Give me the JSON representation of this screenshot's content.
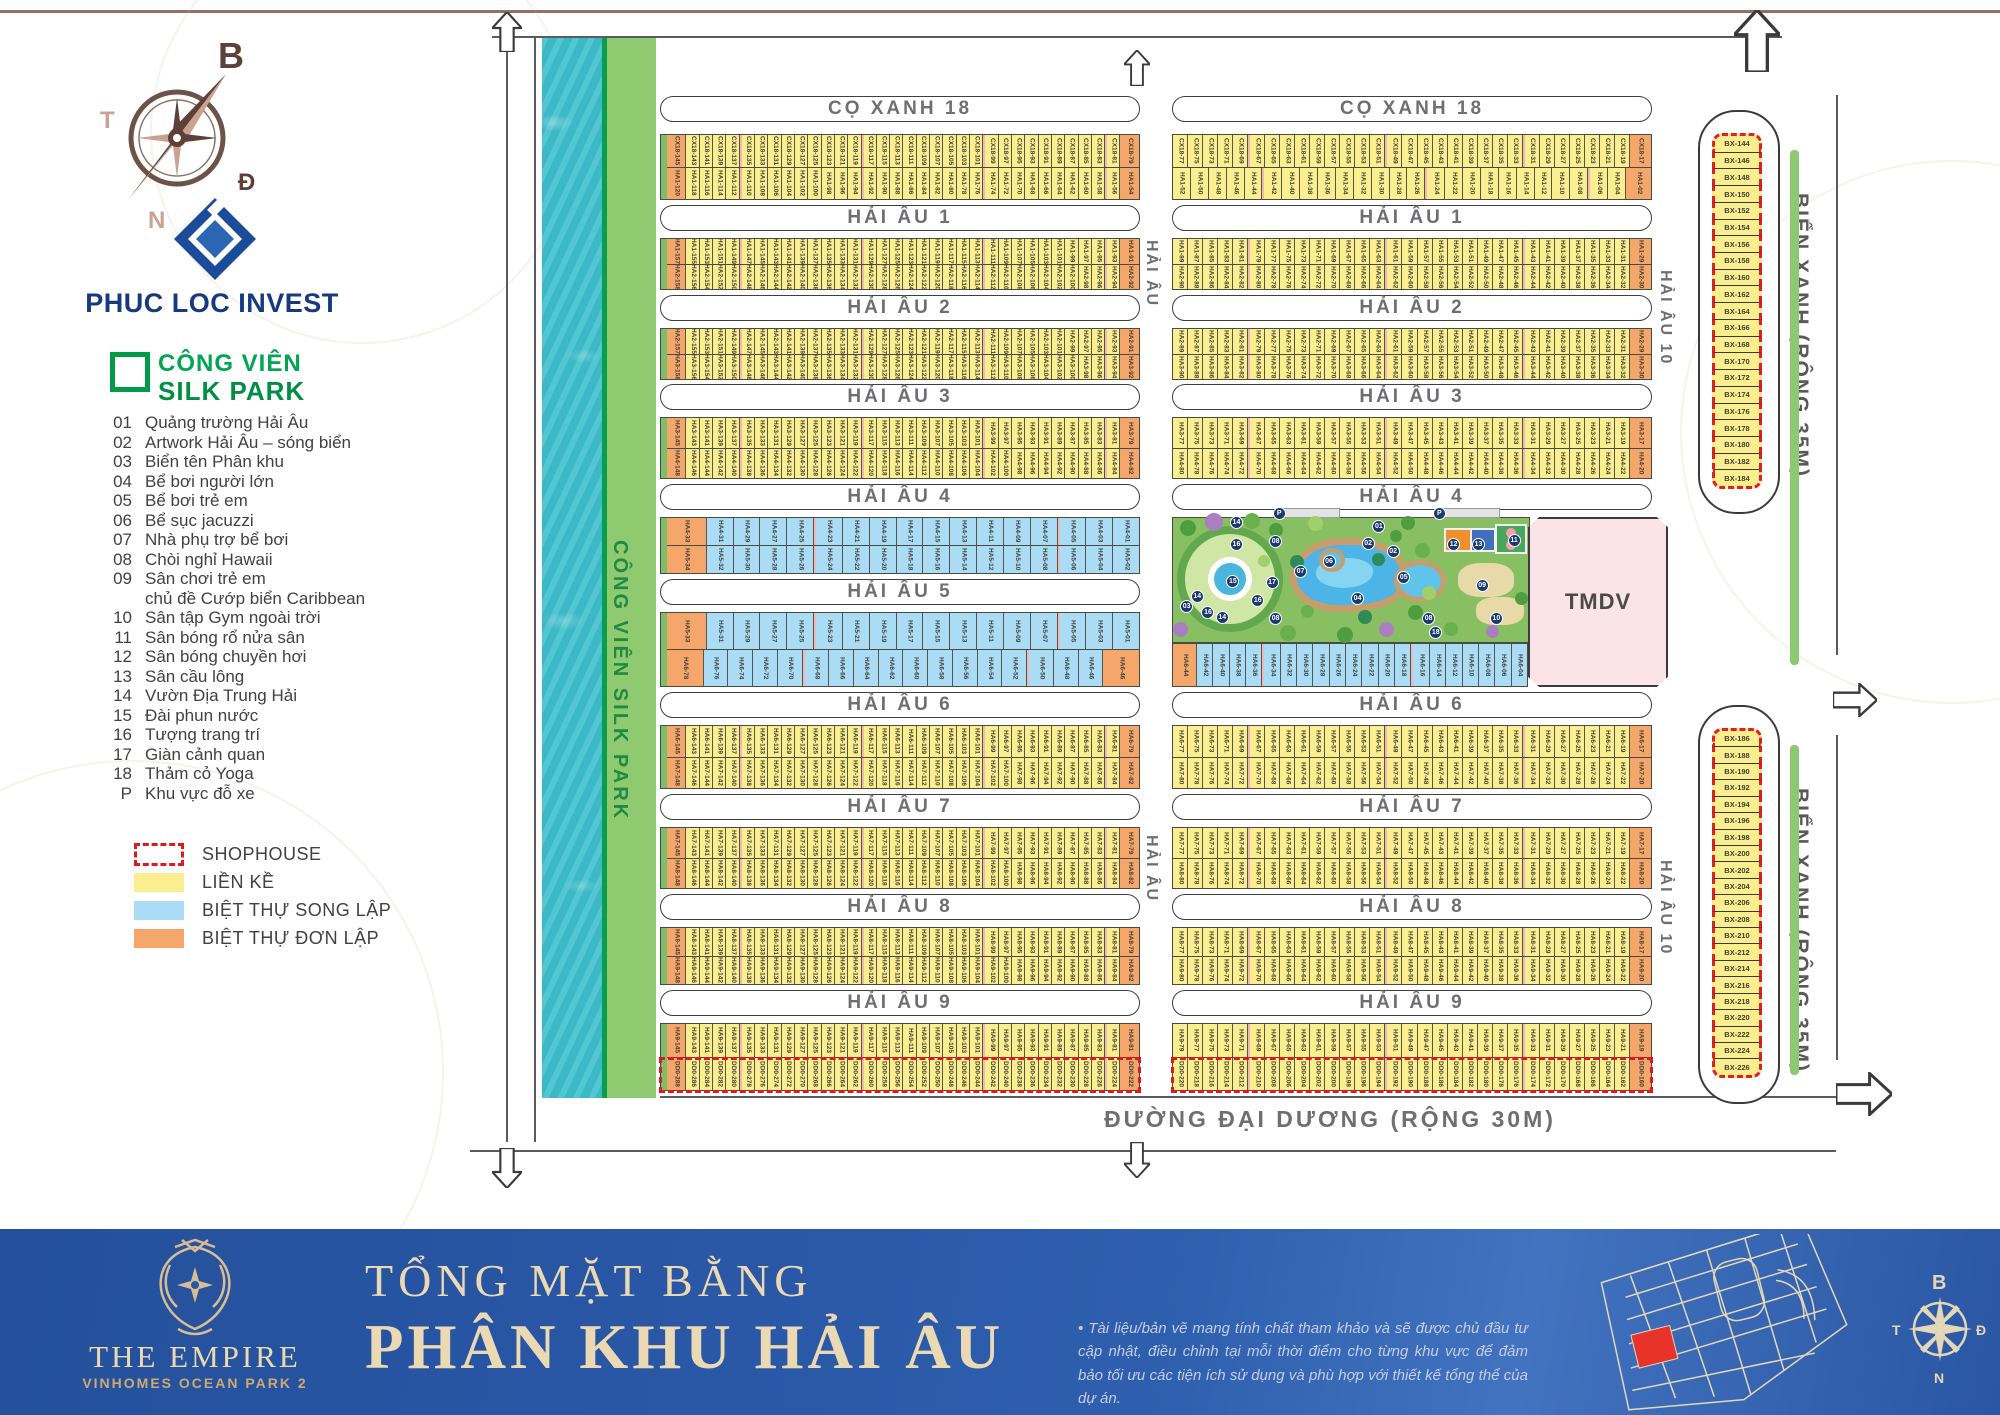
{
  "page_title": "Tổng mặt bằng Phân khu Hải Âu",
  "sidebar": {
    "compass": {
      "north": "B",
      "east": "Đ",
      "south": "N",
      "west": "T"
    },
    "brand": "PHUC LOC INVEST",
    "park_legend": {
      "line1": "CÔNG VIÊN",
      "line2": "SILK PARK"
    },
    "amenities": [
      {
        "no": "01",
        "label": "Quảng trường Hải Âu"
      },
      {
        "no": "02",
        "label": "Artwork Hải Âu – sóng biển"
      },
      {
        "no": "03",
        "label": "Biển tên Phân khu"
      },
      {
        "no": "04",
        "label": "Bể bơi người lớn"
      },
      {
        "no": "05",
        "label": "Bể bơi trẻ em"
      },
      {
        "no": "06",
        "label": "Bể sục jacuzzi"
      },
      {
        "no": "07",
        "label": "Nhà phụ trợ bể bơi"
      },
      {
        "no": "08",
        "label": "Chòi nghỉ Hawaii"
      },
      {
        "no": "09",
        "label": "Sân chơi trẻ em",
        "label2": "chủ đề Cướp biển Caribbean"
      },
      {
        "no": "10",
        "label": "Sân tập Gym ngoài trời"
      },
      {
        "no": "11",
        "label": "Sân bóng rổ nửa sân"
      },
      {
        "no": "12",
        "label": "Sân bóng chuyền hơi"
      },
      {
        "no": "13",
        "label": "Sân cầu lông"
      },
      {
        "no": "14",
        "label": "Vườn Địa Trung Hải"
      },
      {
        "no": "15",
        "label": "Đài phun nước"
      },
      {
        "no": "16",
        "label": "Tượng trang trí"
      },
      {
        "no": "17",
        "label": "Giàn cảnh quan"
      },
      {
        "no": "18",
        "label": "Thảm cỏ Yoga"
      },
      {
        "no": "P",
        "label": "Khu vực đỗ xe"
      }
    ],
    "type_legend": [
      {
        "key": "shophouse",
        "label": "SHOPHOUSE"
      },
      {
        "key": "lienke",
        "label": "LIỀN KỀ"
      },
      {
        "key": "songlap",
        "label": "BIỆT THỰ SONG LẬP"
      },
      {
        "key": "donlap",
        "label": "BIỆT THỰ ĐƠN LẬP"
      }
    ]
  },
  "colors": {
    "lienke": "#fbee8f",
    "songlap": "#abdcf5",
    "donlap": "#f4a66b",
    "shophouse_dash": "#e0191f",
    "park_green": "#8fca70",
    "water": "#3fbfcc",
    "tmdv_pink": "#fbe4e7",
    "footer_blue": "#2a58a7",
    "footer_cream": "#ead9b3"
  },
  "map": {
    "silk_park_vertical_label": "CÔNG VIÊN SILK PARK",
    "bien_xanh_label": "BIỂN XANH (RỘNG 35M)",
    "dai_duong_label": "ĐƯỜNG ĐẠI DƯƠNG (RỘNG 30M)",
    "hai_au_road_label": "HẢI ÂU",
    "hai_au_10_label": "HẢI ÂU 10",
    "tmdv_label": "TMDV",
    "streets": [
      {
        "label": "CỌ XANH 18",
        "y": 96,
        "groups": [
          "L",
          "R"
        ]
      },
      {
        "label": "HẢI ÂU 1",
        "y": 205,
        "groups": [
          "L",
          "R"
        ]
      },
      {
        "label": "HẢI ÂU 2",
        "y": 295,
        "groups": [
          "L",
          "R"
        ]
      },
      {
        "label": "HẢI ÂU 3",
        "y": 384,
        "groups": [
          "L",
          "R"
        ]
      },
      {
        "label": "HẢI ÂU 4",
        "y": 484,
        "groups": [
          "L",
          "R"
        ]
      },
      {
        "label": "HẢI ÂU 5",
        "y": 579,
        "groups": [
          "L"
        ]
      },
      {
        "label": "HẢI ÂU 6",
        "y": 692,
        "groups": [
          "L",
          "R"
        ]
      },
      {
        "label": "HẢI ÂU 7",
        "y": 794,
        "groups": [
          "L",
          "R"
        ]
      },
      {
        "label": "HẢI ÂU 8",
        "y": 894,
        "groups": [
          "L",
          "R"
        ]
      },
      {
        "label": "HẢI ÂU 9",
        "y": 990,
        "groups": [
          "L",
          "R"
        ]
      }
    ],
    "blocks": [
      {
        "g": "L",
        "y": 134,
        "h": 66,
        "t": "y",
        "rows": [
          {
            "p": "CX18",
            "o1": 145,
            "s": 143,
            "n": 32,
            "o2": 79
          },
          {
            "p": "HA1",
            "o1": 120,
            "s": 118,
            "n": 32,
            "o2": 54
          }
        ]
      },
      {
        "g": "R",
        "y": 134,
        "h": 66,
        "t": "y",
        "rows": [
          {
            "p": "CX18",
            "s": 77,
            "n": 30,
            "o2": 17
          },
          {
            "p": "HA1",
            "s": 52,
            "n": 25,
            "o2": 2
          }
        ]
      },
      {
        "g": "L",
        "y": 238,
        "h": 52,
        "t": "y",
        "rows": [
          {
            "p": "HA1",
            "o1": 157,
            "s": 155,
            "n": 32,
            "o2": 91
          },
          {
            "p": "HA2",
            "o1": 158,
            "s": 156,
            "n": 32,
            "o2": 92
          }
        ]
      },
      {
        "g": "R",
        "y": 238,
        "h": 52,
        "t": "y",
        "rows": [
          {
            "p": "HA1",
            "s": 89,
            "n": 30,
            "o2": 29
          },
          {
            "p": "HA2",
            "s": 90,
            "n": 30,
            "o2": 30
          }
        ]
      },
      {
        "g": "L",
        "y": 328,
        "h": 52,
        "t": "y",
        "rows": [
          {
            "p": "HA2",
            "o1": 157,
            "s": 155,
            "n": 32,
            "o2": 91
          },
          {
            "p": "HA3",
            "o1": 158,
            "s": 156,
            "n": 32,
            "o2": 92
          }
        ]
      },
      {
        "g": "R",
        "y": 328,
        "h": 52,
        "t": "y",
        "rows": [
          {
            "p": "HA2",
            "s": 89,
            "n": 30,
            "o2": 29
          },
          {
            "p": "HA3",
            "s": 90,
            "n": 30,
            "o2": 30
          }
        ]
      },
      {
        "g": "L",
        "y": 417,
        "h": 62,
        "t": "y",
        "rows": [
          {
            "p": "HA3",
            "o1": 145,
            "s": 143,
            "n": 32,
            "o2": 79
          },
          {
            "p": "HA4",
            "o1": 148,
            "s": 146,
            "n": 32,
            "o2": 82
          }
        ]
      },
      {
        "g": "R",
        "y": 417,
        "h": 62,
        "t": "y",
        "rows": [
          {
            "p": "HA3",
            "s": 77,
            "n": 30,
            "o2": 17
          },
          {
            "p": "HA4",
            "s": 80,
            "n": 30,
            "o2": 20
          }
        ]
      },
      {
        "g": "L",
        "y": 517,
        "h": 57,
        "t": "b",
        "rows": [
          {
            "p": "HA4",
            "o1": 33,
            "s": 31,
            "n": 16
          },
          {
            "p": "HA5",
            "o1": 34,
            "s": 32,
            "n": 16
          }
        ]
      },
      {
        "g": "L",
        "y": 612,
        "h": 75,
        "t": "b",
        "rows": [
          {
            "p": "HA5",
            "o1": 33,
            "s": 31,
            "n": 16
          },
          {
            "p": "HA6",
            "o1": 78,
            "s": 76,
            "n": 16,
            "o2": 46
          }
        ]
      },
      {
        "g": "R",
        "y": 643,
        "h": 44,
        "t": "b",
        "w": 356,
        "rows": [
          {
            "p": "HA6",
            "o1": 44,
            "s": 42,
            "n": 20
          }
        ]
      },
      {
        "g": "L",
        "y": 725,
        "h": 64,
        "t": "y",
        "rows": [
          {
            "p": "HA6",
            "o1": 145,
            "s": 143,
            "n": 32,
            "o2": 79
          },
          {
            "p": "HA7",
            "o1": 148,
            "s": 146,
            "n": 32,
            "o2": 82
          }
        ]
      },
      {
        "g": "R",
        "y": 725,
        "h": 64,
        "t": "y",
        "rows": [
          {
            "p": "HA6",
            "s": 77,
            "n": 30,
            "o2": 17
          },
          {
            "p": "HA7",
            "s": 80,
            "n": 30,
            "o2": 20
          }
        ]
      },
      {
        "g": "L",
        "y": 827,
        "h": 62,
        "t": "y",
        "rows": [
          {
            "p": "HA7",
            "o1": 145,
            "s": 143,
            "n": 32,
            "o2": 79
          },
          {
            "p": "HA8",
            "o1": 148,
            "s": 146,
            "n": 32,
            "o2": 82
          }
        ]
      },
      {
        "g": "R",
        "y": 827,
        "h": 62,
        "t": "y",
        "rows": [
          {
            "p": "HA7",
            "s": 77,
            "n": 30,
            "o2": 17
          },
          {
            "p": "HA8",
            "s": 80,
            "n": 30,
            "o2": 20
          }
        ]
      },
      {
        "g": "L",
        "y": 927,
        "h": 58,
        "t": "y",
        "rows": [
          {
            "p": "HA8",
            "o1": 145,
            "s": 143,
            "n": 32,
            "o2": 79
          },
          {
            "p": "HA9",
            "o1": 148,
            "s": 146,
            "n": 32,
            "o2": 82
          }
        ]
      },
      {
        "g": "R",
        "y": 927,
        "h": 58,
        "t": "y",
        "rows": [
          {
            "p": "HA8",
            "s": 77,
            "n": 30,
            "o2": 17
          },
          {
            "p": "HA9",
            "s": 80,
            "n": 30,
            "o2": 20
          }
        ]
      },
      {
        "g": "L",
        "y": 1023,
        "h": 68,
        "t": "y",
        "shop": true,
        "rows": [
          {
            "p": "HA9",
            "o1": 145,
            "s": 143,
            "n": 32,
            "o2": 81
          },
          {
            "p": "DD0",
            "o1": 288,
            "s": 286,
            "n": 32,
            "o2": 222
          }
        ]
      },
      {
        "g": "R",
        "y": 1023,
        "h": 68,
        "t": "y",
        "shop": true,
        "rows": [
          {
            "p": "HA9",
            "s": 79,
            "n": 30,
            "o2": 19
          },
          {
            "p": "DD0",
            "s": 220,
            "n": 30,
            "o2": 160
          }
        ]
      }
    ],
    "bx_columns": [
      {
        "outer_y": 110,
        "outer_h": 400,
        "y": 133,
        "h": 356,
        "start": 144,
        "end": 184
      },
      {
        "outer_y": 705,
        "outer_h": 395,
        "y": 728,
        "h": 350,
        "start": 186,
        "end": 226
      }
    ],
    "park_badges": [
      {
        "n": "P",
        "x": 28,
        "y": -9
      },
      {
        "n": "P",
        "x": 73,
        "y": -9
      },
      {
        "n": "01",
        "x": 56,
        "y": 2
      },
      {
        "n": "02",
        "x": 53,
        "y": 15
      },
      {
        "n": "02",
        "x": 60,
        "y": 22
      },
      {
        "n": "06",
        "x": 42,
        "y": 30
      },
      {
        "n": "07",
        "x": 34,
        "y": 38
      },
      {
        "n": "05",
        "x": 63,
        "y": 43
      },
      {
        "n": "04",
        "x": 50,
        "y": 60
      },
      {
        "n": "17",
        "x": 26,
        "y": 47
      },
      {
        "n": "08",
        "x": 27,
        "y": 14
      },
      {
        "n": "08",
        "x": 27,
        "y": 76
      },
      {
        "n": "08",
        "x": 70,
        "y": 76
      },
      {
        "n": "18",
        "x": 72,
        "y": 87
      },
      {
        "n": "09",
        "x": 85,
        "y": 49
      },
      {
        "n": "10",
        "x": 89,
        "y": 76
      },
      {
        "n": "12",
        "x": 77,
        "y": 16
      },
      {
        "n": "13",
        "x": 84,
        "y": 16
      },
      {
        "n": "11",
        "x": 94,
        "y": 13
      },
      {
        "n": "15",
        "x": 15,
        "y": 46
      },
      {
        "n": "16",
        "x": 16,
        "y": 16
      },
      {
        "n": "16",
        "x": 8,
        "y": 71
      },
      {
        "n": "16",
        "x": 22,
        "y": 61
      },
      {
        "n": "14",
        "x": 16,
        "y": -2
      },
      {
        "n": "14",
        "x": 5,
        "y": 58
      },
      {
        "n": "14",
        "x": 12,
        "y": 75
      },
      {
        "n": "03",
        "x": 2,
        "y": 66
      }
    ]
  },
  "footer": {
    "title_line1": "TỔNG MẶT BẰNG",
    "title_line2": "PHÂN KHU HẢI ÂU",
    "brand_line1": "THE EMPIRE",
    "brand_line2": "VINHOMES OCEAN PARK 2",
    "disclaimer": "• Tài liệu/bản vẽ mang tính chất tham khảo và sẽ được chủ đầu tư cập nhật, điều chỉnh tại mỗi thời điểm cho từng khu vực để đảm bảo tối ưu các tiện ích sử dụng và phù hợp với thiết kế tổng thể của dự án.",
    "compass": {
      "north": "B",
      "east": "Đ",
      "south": "N",
      "west": "T"
    }
  }
}
